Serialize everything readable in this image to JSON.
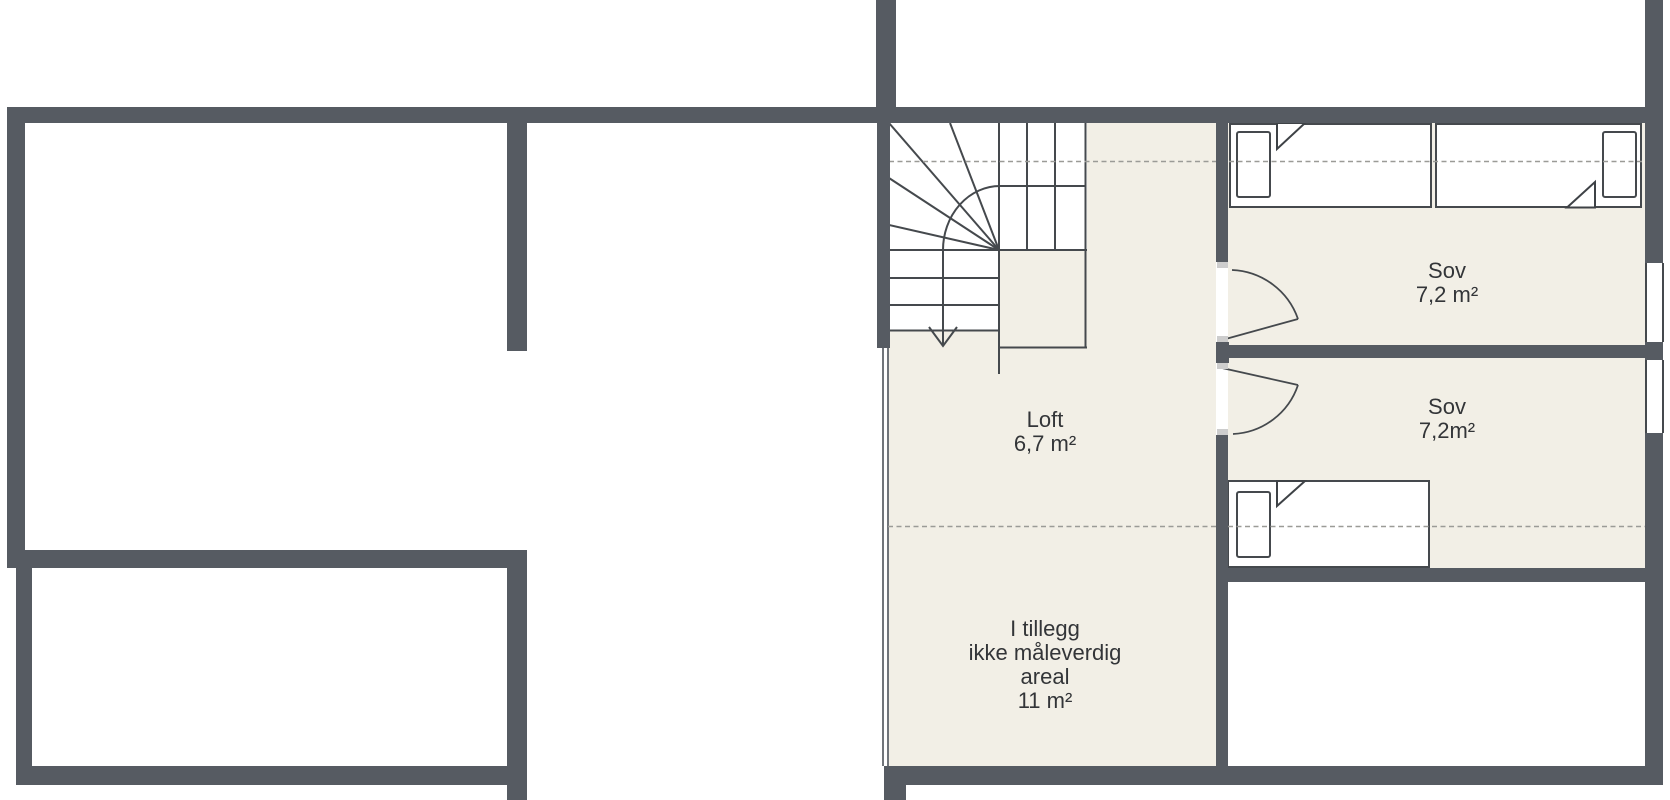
{
  "plan": {
    "type": "floor-plan",
    "language": "Norwegian",
    "rooms": {
      "loft": {
        "name": "Loft",
        "area": "6,7 m²"
      },
      "bedroom1": {
        "name": "Sov",
        "area": "7,2 m²"
      },
      "bedroom2": {
        "name": "Sov",
        "area": "7,2m²"
      },
      "extra": {
        "line1": "I tillegg",
        "line2": "ikke måleverdig",
        "line3": "areal",
        "line4": "11 m²"
      }
    },
    "features": {
      "staircase": "winder-staircase-with-down-arrow",
      "beds": 3,
      "door_swings": 2,
      "windows": 2,
      "dashed_lines": "headroom-measure-boundaries"
    },
    "colors": {
      "wall": "#565b62",
      "floor": "#f2efe6",
      "line": "#45494d",
      "dashed": "#9b9b97",
      "text": "#333538"
    }
  }
}
